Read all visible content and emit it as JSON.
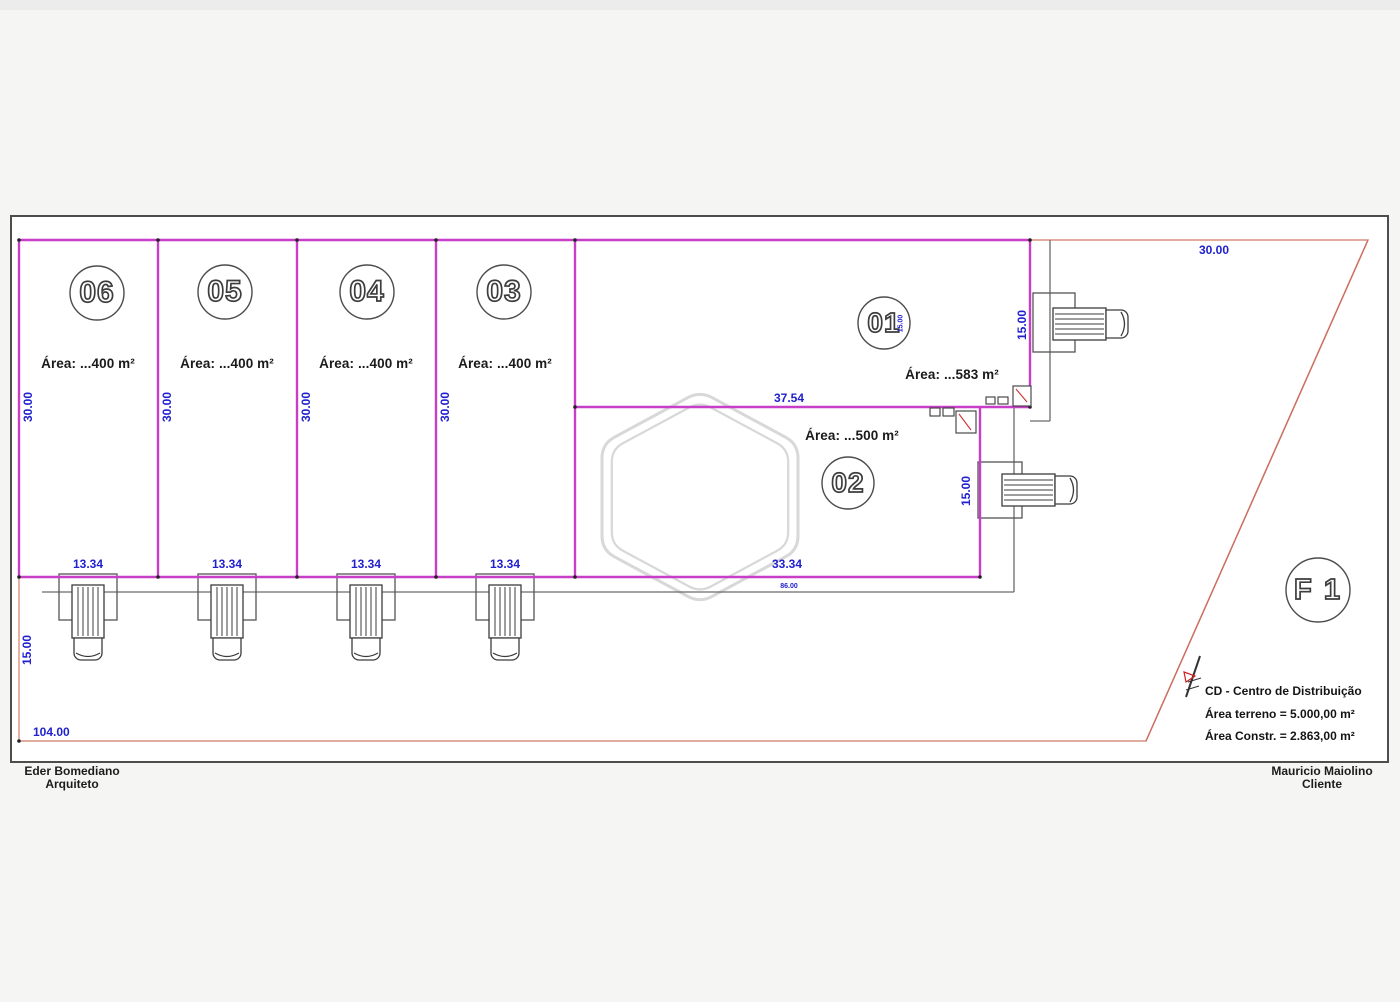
{
  "lots": [
    {
      "number": "06",
      "area_label": "Área: ...400 m²",
      "width": "13.34",
      "depth": "30.00"
    },
    {
      "number": "05",
      "area_label": "Área: ...400 m²",
      "width": "13.34",
      "depth": "30.00"
    },
    {
      "number": "04",
      "area_label": "Área: ...400 m²",
      "width": "13.34",
      "depth": "30.00"
    },
    {
      "number": "03",
      "area_label": "Área: ...400 m²",
      "width": "13.34",
      "depth": "30.00"
    },
    {
      "number": "01",
      "area_label": "Área: ...583 m²",
      "frontage": "37.54",
      "side": "15.00"
    },
    {
      "number": "02",
      "area_label": "Área: ...500 m²",
      "frontage": "33.34",
      "side": "15.00"
    }
  ],
  "dimensions": {
    "top_right": "30.00",
    "left_height": "15.00",
    "bottom_width": "104.00",
    "building_length": "86.00",
    "lot01_inner": "15.00"
  },
  "legend": {
    "sheet": "F 1",
    "line1": "CD - Centro de Distribuição",
    "line2": "Área terreno = 5.000,00 m²",
    "line3": "Área Constr. = 2.863,00 m²"
  },
  "footer": {
    "architect_name": "Eder Bomediano",
    "architect_role": "Arquiteto",
    "client_name": "Mauricio Maiolino",
    "client_role": "Cliente"
  },
  "colors": {
    "lot_boundary": "#c73fc7",
    "dimension_text": "#2020cf",
    "site_boundary": "#d9907e",
    "linework": "#5a5a5a"
  }
}
